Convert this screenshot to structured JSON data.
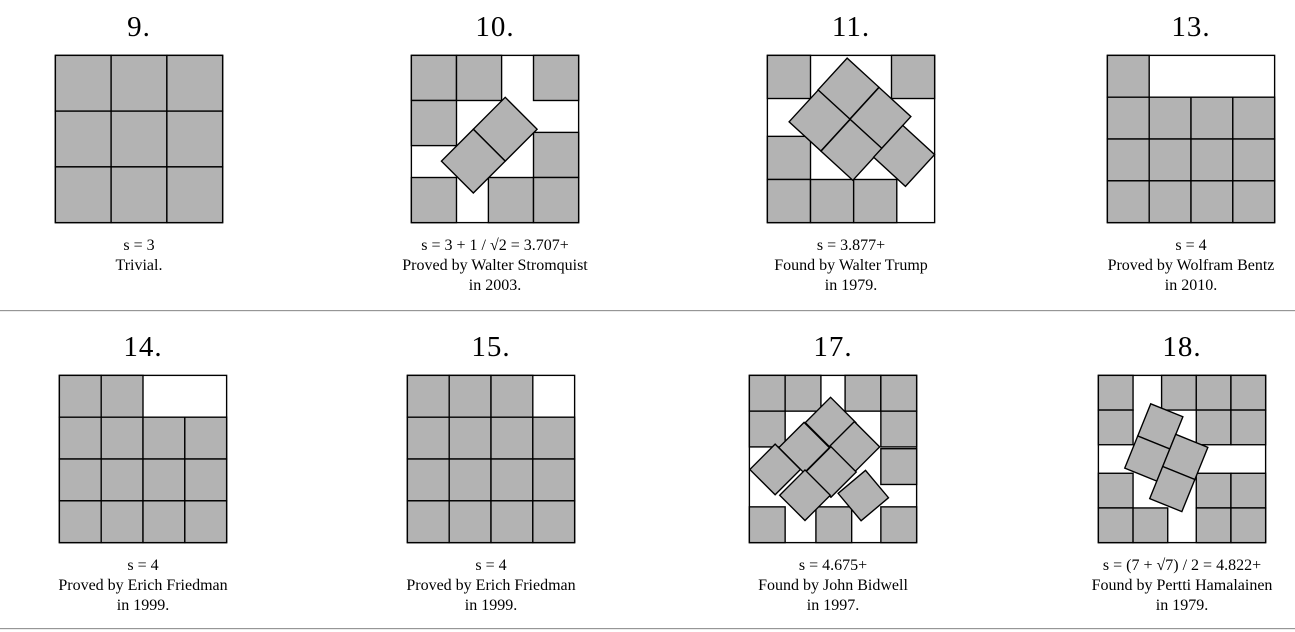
{
  "page": {
    "background": "#ffffff",
    "square_fill": "#b3b3b3",
    "square_stroke": "#000000",
    "separator_color": "#969696"
  },
  "panels": [
    {
      "number": "9.",
      "caption_lines": [
        "s = 3",
        "Trivial."
      ],
      "packing": {
        "s": 3,
        "grid": [
          [
            0,
            0
          ],
          [
            1,
            0
          ],
          [
            2,
            0
          ],
          [
            0,
            1
          ],
          [
            1,
            1
          ],
          [
            2,
            1
          ],
          [
            0,
            2
          ],
          [
            1,
            2
          ],
          [
            2,
            2
          ]
        ],
        "tilted": []
      }
    },
    {
      "number": "10.",
      "caption_lines": [
        "s = 3 + 1 / √2 = 3.707+",
        "Proved by Walter Stromquist",
        "in 2003."
      ],
      "packing": {
        "s": 3.7071,
        "grid": [
          [
            0,
            0
          ],
          [
            1,
            0
          ],
          [
            2.7071,
            0
          ],
          [
            0,
            1
          ],
          [
            2.7071,
            1.7071
          ],
          [
            0,
            2.7071
          ],
          [
            1.7071,
            2.7071
          ],
          [
            2.7071,
            2.7071
          ]
        ],
        "tilted": [
          {
            "x": 2.08,
            "y": 1.637,
            "r": 45
          },
          {
            "x": 1.373,
            "y": 2.344,
            "r": 45
          }
        ]
      }
    },
    {
      "number": "11.",
      "caption_lines": [
        "s = 3.877+",
        "Found by Walter Trump",
        "in 1979."
      ],
      "packing": {
        "s": 3.8772,
        "grid": [
          [
            0,
            0
          ],
          [
            2.8772,
            0
          ],
          [
            0,
            1.8772
          ],
          [
            0,
            2.8772
          ],
          [
            1,
            2.8772
          ],
          [
            2,
            2.8772
          ]
        ],
        "tilted": [
          {
            "x": 1.88,
            "y": 0.77,
            "r": 42.5
          },
          {
            "x": 2.62,
            "y": 1.45,
            "r": 42.5
          },
          {
            "x": 1.21,
            "y": 1.51,
            "r": 42.5
          },
          {
            "x": 1.95,
            "y": 2.19,
            "r": 42.5
          },
          {
            "x": 3.17,
            "y": 2.33,
            "r": 42.5
          }
        ]
      }
    },
    {
      "number": "13.",
      "caption_lines": [
        "s = 4",
        "Proved by Wolfram Bentz",
        "in 2010."
      ],
      "packing": {
        "s": 4,
        "grid": [
          [
            0,
            0
          ],
          [
            0,
            1
          ],
          [
            1,
            1
          ],
          [
            2,
            1
          ],
          [
            3,
            1
          ],
          [
            0,
            2
          ],
          [
            1,
            2
          ],
          [
            2,
            2
          ],
          [
            3,
            2
          ],
          [
            0,
            3
          ],
          [
            1,
            3
          ],
          [
            2,
            3
          ],
          [
            3,
            3
          ]
        ],
        "tilted": []
      }
    },
    {
      "number": "14.",
      "caption_lines": [
        "s = 4",
        "Proved by Erich Friedman",
        "in 1999."
      ],
      "packing": {
        "s": 4,
        "grid": [
          [
            0,
            0
          ],
          [
            1,
            0
          ],
          [
            0,
            1
          ],
          [
            1,
            1
          ],
          [
            2,
            1
          ],
          [
            3,
            1
          ],
          [
            0,
            2
          ],
          [
            1,
            2
          ],
          [
            2,
            2
          ],
          [
            3,
            2
          ],
          [
            0,
            3
          ],
          [
            1,
            3
          ],
          [
            2,
            3
          ],
          [
            3,
            3
          ]
        ],
        "tilted": []
      }
    },
    {
      "number": "15.",
      "caption_lines": [
        "s = 4",
        "Proved by Erich Friedman",
        "in 1999."
      ],
      "packing": {
        "s": 4,
        "grid": [
          [
            0,
            0
          ],
          [
            1,
            0
          ],
          [
            2,
            0
          ],
          [
            0,
            1
          ],
          [
            1,
            1
          ],
          [
            2,
            1
          ],
          [
            3,
            1
          ],
          [
            0,
            2
          ],
          [
            1,
            2
          ],
          [
            2,
            2
          ],
          [
            3,
            2
          ],
          [
            0,
            3
          ],
          [
            1,
            3
          ],
          [
            2,
            3
          ],
          [
            3,
            3
          ]
        ],
        "tilted": []
      }
    },
    {
      "number": "17.",
      "caption_lines": [
        "s = 4.675+",
        "Found by John Bidwell",
        "in 1997."
      ],
      "packing": {
        "s": 4.6756,
        "grid": [
          [
            0,
            0
          ],
          [
            1,
            0
          ],
          [
            2.6756,
            0
          ],
          [
            3.6756,
            0
          ],
          [
            0,
            1
          ],
          [
            3.6756,
            1
          ],
          [
            3.6756,
            2.05
          ],
          [
            0,
            3.6756
          ],
          [
            1.86,
            3.6756
          ],
          [
            3.6756,
            3.6756
          ]
        ],
        "tilted": [
          {
            "x": 2.27,
            "y": 1.32,
            "r": 45
          },
          {
            "x": 1.53,
            "y": 2.02,
            "r": 45
          },
          {
            "x": 2.935,
            "y": 2.0,
            "r": 45
          },
          {
            "x": 2.28,
            "y": 2.7,
            "r": 45
          },
          {
            "x": 0.72,
            "y": 2.63,
            "r": 45
          },
          {
            "x": 1.555,
            "y": 3.35,
            "r": 45
          },
          {
            "x": 3.185,
            "y": 3.36,
            "r": 50
          }
        ]
      }
    },
    {
      "number": "18.",
      "caption_lines": [
        "s = (7 + √7) / 2 = 4.822+",
        "Found by Pertti Hamalainen",
        "in 1979."
      ],
      "packing": {
        "s": 4.8229,
        "grid": [
          [
            0,
            0
          ],
          [
            1.8229,
            0
          ],
          [
            2.8229,
            0
          ],
          [
            3.8229,
            0
          ],
          [
            0,
            1
          ],
          [
            2.8229,
            1
          ],
          [
            3.8229,
            1
          ],
          [
            0,
            2.8229
          ],
          [
            2.8229,
            2.8229
          ],
          [
            3.8229,
            2.8229
          ],
          [
            0,
            3.8229
          ],
          [
            1,
            3.8229
          ],
          [
            2.8229,
            3.8229
          ],
          [
            3.8229,
            3.8229
          ]
        ],
        "tilted": [
          {
            "x": 1.786,
            "y": 1.471,
            "r": 22
          },
          {
            "x": 1.411,
            "y": 2.398,
            "r": 22
          },
          {
            "x": 2.506,
            "y": 2.351,
            "r": 22
          },
          {
            "x": 2.131,
            "y": 3.278,
            "r": 22
          }
        ]
      }
    }
  ]
}
